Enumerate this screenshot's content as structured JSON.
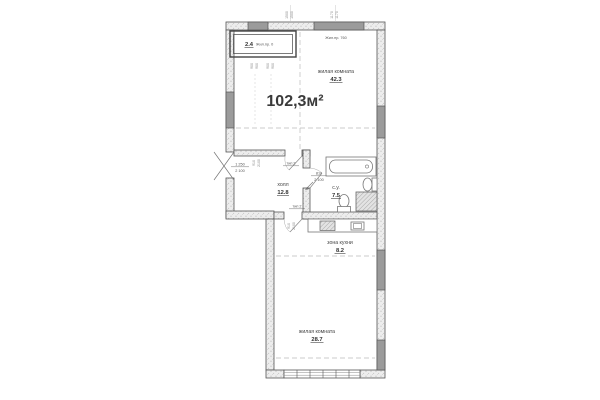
{
  "plan": {
    "total_area": "102,3м²",
    "accent_green": "#00a651",
    "rooms": {
      "living_top": {
        "name": "жилая комната",
        "area": "42.3"
      },
      "balcony": {
        "area": "2.4",
        "note": "Жил.пр. 0"
      },
      "hall": {
        "name": "холл",
        "area": "12.8"
      },
      "bathroom": {
        "name": "с.у.",
        "area": "7.5"
      },
      "kitchen": {
        "name": "зона кухни",
        "area": "8.2"
      },
      "living_bottom": {
        "name": "жилая комната",
        "area": "28.7"
      }
    },
    "notes": {
      "top_right": "Жил.пр. 760"
    },
    "doors": {
      "type_a": "тип 2",
      "type_b": "тип 2",
      "entry_w": "1 250",
      "entry_h": "2 100",
      "bath_w": "810",
      "bath_h": "2 100"
    },
    "dims": {
      "top_a1": "1500",
      "top_a2": "1500",
      "top_b1": "1170",
      "top_b2": "1170",
      "balc_a1": "900",
      "balc_a2": "900",
      "balc_b1": "900",
      "balc_b2": "900",
      "mid_a1": "910",
      "mid_a2": "2100",
      "mid_b1": "910",
      "mid_b2": "2100"
    }
  }
}
